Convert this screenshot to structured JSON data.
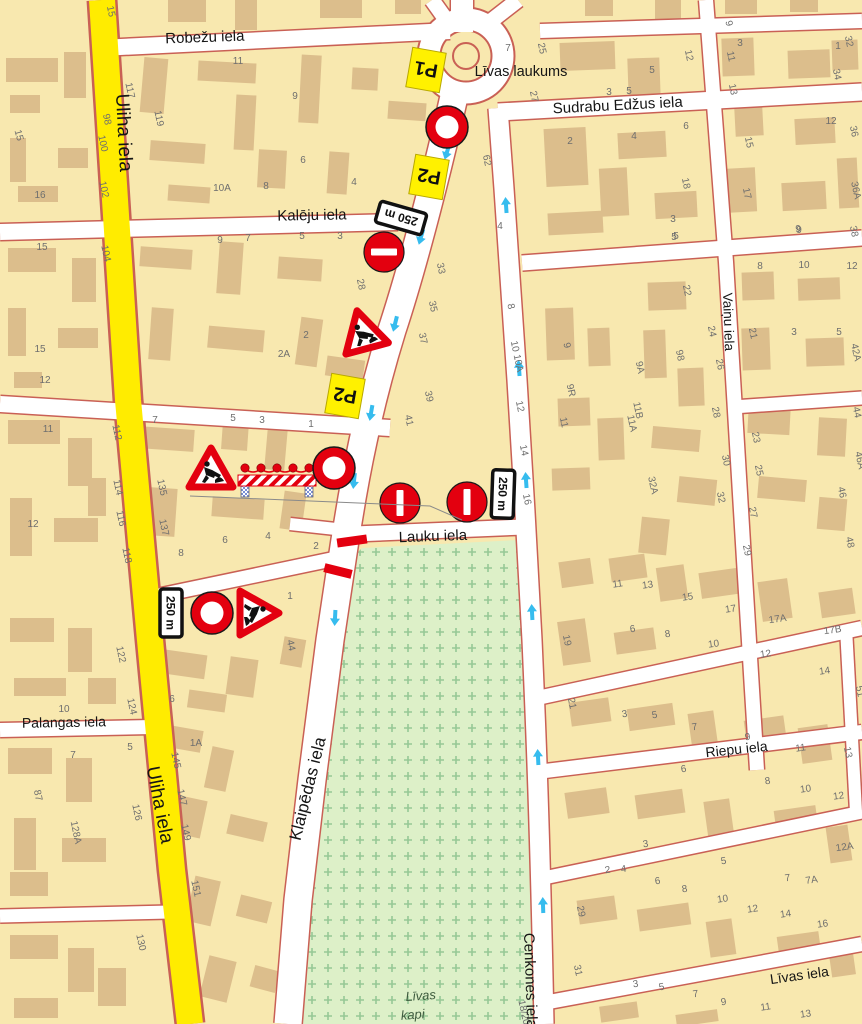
{
  "map": {
    "region_names": {
      "square": "Līvas laukums",
      "cemetery_line1": "Līvas",
      "cemetery_line2": "kapi"
    },
    "street_labels": [
      {
        "id": "robezu",
        "text": "Robežu iela",
        "x": 205,
        "y": 42,
        "rot": -2,
        "size": 15
      },
      {
        "id": "uliha-top",
        "text": "Uliha iela",
        "x": 118,
        "y": 133,
        "rot": 87,
        "size": 19
      },
      {
        "id": "kaleju",
        "text": "Kalēju iela",
        "x": 312,
        "y": 220,
        "rot": -1,
        "size": 15
      },
      {
        "id": "sudrabu-edzus",
        "text": "Sudrabu Edžus iela",
        "x": 618,
        "y": 110,
        "rot": -3,
        "size": 15
      },
      {
        "id": "vainu",
        "text": "Vaiņu iela",
        "x": 724,
        "y": 322,
        "rot": 88,
        "size": 13.5
      },
      {
        "id": "lauku",
        "text": "Lauku iela",
        "x": 433,
        "y": 541,
        "rot": -2,
        "size": 15
      },
      {
        "id": "klaipedas",
        "text": "Klaipēdas iela",
        "x": 313,
        "y": 790,
        "rot": -76,
        "size": 17
      },
      {
        "id": "uliha-bottom",
        "text": "Uliha iela",
        "x": 154,
        "y": 806,
        "rot": 79,
        "size": 19
      },
      {
        "id": "palangas",
        "text": "Palangas iela",
        "x": 64,
        "y": 727,
        "rot": -1,
        "size": 14
      },
      {
        "id": "riepu",
        "text": "Riepu iela",
        "x": 737,
        "y": 754,
        "rot": -6,
        "size": 14
      },
      {
        "id": "cenkones",
        "text": "Cenkones iela",
        "x": 524,
        "y": 933,
        "rot": 88,
        "size": 15,
        "anchor": "start"
      },
      {
        "id": "livas-iela",
        "text": "Līvas iela",
        "x": 800,
        "y": 980,
        "rot": -8,
        "size": 14
      }
    ],
    "place_labels": [
      {
        "id": "livas-laukums",
        "text": "Līvas laukums",
        "x": 521,
        "y": 76,
        "rot": 0,
        "size": 14.5,
        "cls": "place-label"
      },
      {
        "id": "livas-kapi-1",
        "text": "Līvas",
        "x": 421,
        "y": 1000,
        "rot": -4,
        "size": 13,
        "cls": "kapi"
      },
      {
        "id": "livas-kapi-2",
        "text": "kapi",
        "x": 413,
        "y": 1019,
        "rot": -4,
        "size": 13,
        "cls": "kapi"
      }
    ],
    "signs": [
      {
        "id": "detour-p1",
        "type": "plate-p",
        "label": "P1",
        "x": 426,
        "y": 70,
        "rot": 190
      },
      {
        "id": "closed-ring-north",
        "type": "ring",
        "x": 447,
        "y": 127,
        "rot": 0
      },
      {
        "id": "detour-p2-a",
        "type": "plate-p",
        "label": "P2",
        "x": 429,
        "y": 177,
        "rot": 190
      },
      {
        "id": "plate-250-a",
        "type": "plate-250",
        "label": "250 m",
        "x": 401,
        "y": 218,
        "rot": 196
      },
      {
        "id": "no-entry-a",
        "type": "no-entry",
        "x": 384,
        "y": 252,
        "rot": 0
      },
      {
        "id": "roadworks-a",
        "type": "works",
        "x": 363,
        "y": 333,
        "rot": -15
      },
      {
        "id": "detour-p2-b",
        "type": "plate-p",
        "label": "P2",
        "x": 345,
        "y": 396,
        "rot": 190
      },
      {
        "id": "roadworks-b",
        "type": "works",
        "x": 211,
        "y": 471,
        "rot": 0
      },
      {
        "id": "barrier",
        "type": "barrier",
        "x": 277,
        "y": 477,
        "rot": 0
      },
      {
        "id": "closed-ring-mid",
        "type": "ring",
        "x": 334,
        "y": 468,
        "rot": 0
      },
      {
        "id": "no-entry-b",
        "type": "no-entry",
        "x": 400,
        "y": 503,
        "rot": 90
      },
      {
        "id": "no-entry-c",
        "type": "no-entry",
        "x": 467,
        "y": 502,
        "rot": 90
      },
      {
        "id": "plate-250-b",
        "type": "plate-250",
        "label": "250 m",
        "x": 503,
        "y": 494,
        "rot": 92
      },
      {
        "id": "closure-bar-1",
        "type": "closure",
        "x": 352,
        "y": 541,
        "rot": -8,
        "len": 30
      },
      {
        "id": "closure-bar-2",
        "type": "closure",
        "x": 338,
        "y": 571,
        "rot": 14,
        "len": 28
      },
      {
        "id": "plate-250-c",
        "type": "plate-250",
        "label": "250 m",
        "x": 171,
        "y": 613,
        "rot": 90
      },
      {
        "id": "closed-ring-south",
        "type": "ring",
        "x": 212,
        "y": 613,
        "rot": 0
      },
      {
        "id": "roadworks-c",
        "type": "works",
        "x": 256,
        "y": 613,
        "rot": 90
      },
      {
        "id": "leader-line",
        "type": "leader",
        "points": [
          [
            190,
            496
          ],
          [
            430,
            506
          ],
          [
            462,
            520
          ]
        ]
      }
    ],
    "flow_arrows": [
      {
        "x": 447,
        "y": 152,
        "rot": 197
      },
      {
        "x": 421,
        "y": 237,
        "rot": 196
      },
      {
        "x": 395,
        "y": 324,
        "rot": 194
      },
      {
        "x": 371,
        "y": 413,
        "rot": 190
      },
      {
        "x": 354,
        "y": 481,
        "rot": 186
      },
      {
        "x": 335,
        "y": 618,
        "rot": 183
      },
      {
        "x": 506,
        "y": 205,
        "rot": -4
      },
      {
        "x": 519,
        "y": 368,
        "rot": -4
      },
      {
        "x": 526,
        "y": 480,
        "rot": -4
      },
      {
        "x": 532,
        "y": 612,
        "rot": -3
      },
      {
        "x": 538,
        "y": 757,
        "rot": -3
      },
      {
        "x": 543,
        "y": 905,
        "rot": -2
      }
    ],
    "house_numbers": [
      [
        "15",
        16,
        136,
        75
      ],
      [
        "16",
        40,
        198,
        0
      ],
      [
        "15",
        42,
        250,
        0
      ],
      [
        "15",
        40,
        352,
        0
      ],
      [
        "12",
        45,
        383,
        0
      ],
      [
        "11",
        48,
        432,
        0
      ],
      [
        "12",
        33,
        527,
        0
      ],
      [
        "98",
        104,
        120,
        78
      ],
      [
        "100",
        100,
        144,
        78
      ],
      [
        "102",
        101,
        190,
        78
      ],
      [
        "104",
        103,
        254,
        78
      ],
      [
        "122",
        118,
        655,
        78
      ],
      [
        "124",
        129,
        707,
        78
      ],
      [
        "126",
        134,
        813,
        78
      ],
      [
        "128A",
        73,
        833,
        78
      ],
      [
        "87",
        35,
        796,
        78
      ],
      [
        "130",
        138,
        943,
        78
      ],
      [
        "10",
        64,
        712,
        0
      ],
      [
        "7",
        73,
        758,
        0
      ],
      [
        "5",
        130,
        750,
        0
      ],
      [
        "117",
        127,
        91,
        78
      ],
      [
        "119",
        156,
        119,
        78
      ],
      [
        "112",
        114,
        433,
        78
      ],
      [
        "114",
        115,
        488,
        78
      ],
      [
        "116",
        118,
        519,
        78
      ],
      [
        "118",
        124,
        556,
        78
      ],
      [
        "135",
        159,
        488,
        78
      ],
      [
        "137",
        161,
        528,
        78
      ],
      [
        "145",
        173,
        761,
        78
      ],
      [
        "147",
        179,
        798,
        78
      ],
      [
        "149",
        183,
        833,
        78
      ],
      [
        "151",
        193,
        889,
        78
      ],
      [
        "6",
        172,
        702,
        0
      ],
      [
        "15",
        108,
        12,
        78
      ],
      [
        "11",
        238,
        64,
        0
      ],
      [
        "9",
        295,
        99,
        0
      ],
      [
        "7",
        508,
        51,
        0
      ],
      [
        "5",
        652,
        73,
        0
      ],
      [
        "3",
        740,
        46,
        0
      ],
      [
        "1",
        838,
        49,
        0
      ],
      [
        "10A",
        222,
        191,
        0
      ],
      [
        "8",
        266,
        189,
        0
      ],
      [
        "6",
        303,
        163,
        0
      ],
      [
        "4",
        354,
        185,
        0
      ],
      [
        "9",
        220,
        243,
        0
      ],
      [
        "7",
        248,
        241,
        0
      ],
      [
        "5",
        302,
        239,
        0
      ],
      [
        "3",
        340,
        239,
        0
      ],
      [
        "2A",
        284,
        357,
        0
      ],
      [
        "2",
        306,
        338,
        0
      ],
      [
        "1",
        311,
        427,
        0
      ],
      [
        "28",
        358,
        285,
        78
      ],
      [
        "33",
        438,
        269,
        78
      ],
      [
        "62",
        484,
        161,
        78
      ],
      [
        "4",
        500,
        229,
        0
      ],
      [
        "35",
        430,
        307,
        78
      ],
      [
        "37",
        420,
        339,
        78
      ],
      [
        "39",
        426,
        397,
        78
      ],
      [
        "41",
        406,
        421,
        78
      ],
      [
        "7",
        155,
        423,
        0
      ],
      [
        "5",
        233,
        421,
        0
      ],
      [
        "3",
        262,
        423,
        0
      ],
      [
        "8",
        181,
        556,
        0
      ],
      [
        "6",
        225,
        543,
        0
      ],
      [
        "4",
        268,
        539,
        0
      ],
      [
        "2",
        316,
        549,
        0
      ],
      [
        "1",
        290,
        599,
        0
      ],
      [
        "44",
        288,
        646,
        78
      ],
      [
        "1A",
        196,
        746,
        0
      ],
      [
        "8",
        508,
        307,
        78
      ],
      [
        "10 10A",
        514,
        357,
        78
      ],
      [
        "12",
        517,
        407,
        78
      ],
      [
        "14",
        521,
        451,
        78
      ],
      [
        "16",
        524,
        500,
        78
      ],
      [
        "9",
        564,
        346,
        78
      ],
      [
        "9R",
        568,
        391,
        78
      ],
      [
        "9A",
        637,
        368,
        78
      ],
      [
        "11",
        561,
        423,
        78
      ],
      [
        "11B",
        635,
        411,
        78
      ],
      [
        "11A",
        629,
        424,
        78
      ],
      [
        "22",
        684,
        291,
        78
      ],
      [
        "24",
        709,
        332,
        78
      ],
      [
        "26",
        717,
        365,
        78
      ],
      [
        "98",
        677,
        356,
        78
      ],
      [
        "8",
        760,
        269,
        0
      ],
      [
        "10",
        804,
        268,
        0
      ],
      [
        "12",
        852,
        269,
        0
      ],
      [
        "3",
        794,
        335,
        0
      ],
      [
        "5",
        839,
        335,
        0
      ],
      [
        "21",
        750,
        334,
        78
      ],
      [
        "42A",
        853,
        353,
        78
      ],
      [
        "5",
        676,
        239,
        0
      ],
      [
        "9",
        799,
        233,
        0
      ],
      [
        "28",
        713,
        413,
        78
      ],
      [
        "30",
        723,
        461,
        78
      ],
      [
        "32",
        718,
        498,
        78
      ],
      [
        "23",
        753,
        438,
        78
      ],
      [
        "25",
        756,
        471,
        78
      ],
      [
        "27",
        750,
        513,
        78
      ],
      [
        "29",
        744,
        551,
        78
      ],
      [
        "32A",
        650,
        486,
        78
      ],
      [
        "44",
        854,
        413,
        78
      ],
      [
        "46A",
        857,
        461,
        78
      ],
      [
        "46",
        839,
        493,
        78
      ],
      [
        "48",
        847,
        543,
        78
      ],
      [
        "9",
        726,
        24,
        78
      ],
      [
        "11",
        728,
        57,
        78
      ],
      [
        "13",
        730,
        90,
        78
      ],
      [
        "32",
        846,
        42,
        78
      ],
      [
        "34",
        834,
        75,
        78
      ],
      [
        "12",
        831,
        124,
        0
      ],
      [
        "15",
        746,
        143,
        78
      ],
      [
        "17",
        744,
        194,
        78
      ],
      [
        "36",
        851,
        132,
        78
      ],
      [
        "36A",
        853,
        191,
        78
      ],
      [
        "38",
        851,
        232,
        78
      ],
      [
        "9",
        798,
        232,
        0
      ],
      [
        "3",
        609,
        95,
        0
      ],
      [
        "5",
        629,
        94,
        0
      ],
      [
        "2",
        570,
        144,
        0
      ],
      [
        "4",
        634,
        139,
        0
      ],
      [
        "6",
        686,
        129,
        0
      ],
      [
        "18",
        683,
        184,
        78
      ],
      [
        "3",
        673,
        222,
        0
      ],
      [
        "5",
        674,
        240,
        0
      ],
      [
        "12",
        686,
        56,
        78
      ],
      [
        "25",
        539,
        49,
        78
      ],
      [
        "27",
        531,
        97,
        78
      ],
      [
        "11",
        618,
        587,
        -8
      ],
      [
        "13",
        648,
        588,
        -8
      ],
      [
        "15",
        688,
        600,
        -8
      ],
      [
        "17",
        731,
        612,
        -8
      ],
      [
        "17A",
        778,
        622,
        -8
      ],
      [
        "17B",
        833,
        633,
        -8
      ],
      [
        "19",
        564,
        641,
        78
      ],
      [
        "21",
        569,
        704,
        78
      ],
      [
        "6",
        633,
        632,
        -8
      ],
      [
        "8",
        668,
        637,
        -8
      ],
      [
        "10",
        714,
        647,
        -8
      ],
      [
        "12",
        766,
        657,
        -8
      ],
      [
        "14",
        825,
        674,
        -8
      ],
      [
        "51",
        857,
        692,
        78
      ],
      [
        "3",
        625,
        717,
        -8
      ],
      [
        "5",
        655,
        718,
        -8
      ],
      [
        "7",
        695,
        730,
        -8
      ],
      [
        "9",
        748,
        740,
        -8
      ],
      [
        "11",
        801,
        751,
        -8
      ],
      [
        "13",
        845,
        753,
        78
      ],
      [
        "6",
        684,
        772,
        -8
      ],
      [
        "8",
        768,
        784,
        -8
      ],
      [
        "10",
        806,
        792,
        -8
      ],
      [
        "12",
        839,
        799,
        -8
      ],
      [
        "29",
        578,
        912,
        78
      ],
      [
        "31",
        575,
        971,
        78
      ],
      [
        "3",
        646,
        847,
        -8
      ],
      [
        "5",
        724,
        864,
        -8
      ],
      [
        "7",
        788,
        881,
        -8
      ],
      [
        "7A",
        812,
        883,
        -8
      ],
      [
        "12A",
        845,
        850,
        -8
      ],
      [
        "2",
        608,
        873,
        -8
      ],
      [
        "4",
        624,
        872,
        -8
      ],
      [
        "6",
        658,
        884,
        -8
      ],
      [
        "8",
        685,
        892,
        -8
      ],
      [
        "10",
        723,
        902,
        -8
      ],
      [
        "12",
        753,
        912,
        -8
      ],
      [
        "14",
        786,
        917,
        -8
      ],
      [
        "16",
        823,
        927,
        -8
      ],
      [
        "3",
        636,
        987,
        -8
      ],
      [
        "5",
        662,
        990,
        -8
      ],
      [
        "7",
        696,
        997,
        -8
      ],
      [
        "9",
        724,
        1005,
        -8
      ],
      [
        "11",
        766,
        1010,
        -8
      ],
      [
        "13",
        806,
        1017,
        -8
      ],
      [
        "18/20",
        521,
        1013,
        78
      ]
    ],
    "colors": {
      "block": "#F8E8AF",
      "building": "#DCBE8C",
      "street": "#FFFFFF",
      "casing": "#C96055",
      "uliha_yellow": "#FFEC00",
      "cemetery": "#DDF0C8",
      "cemetery_cross": "#96C896",
      "arrow": "#36BCEE",
      "sign_red": "#E3000F",
      "plate_yellow": "#FFF100",
      "number_gray": "#6E6E6E",
      "label_black": "#151515",
      "kapi_green": "#3E5B3E"
    }
  }
}
